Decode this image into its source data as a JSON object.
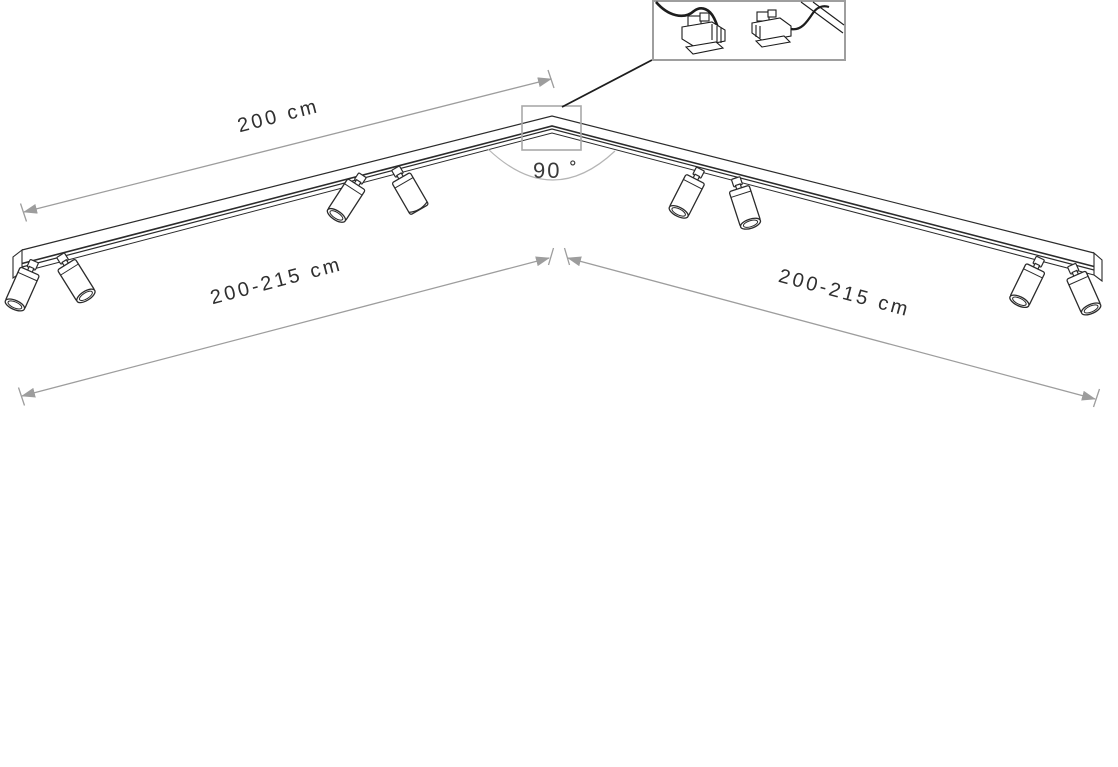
{
  "diagram": {
    "type": "product-dimension-diagram",
    "subject": "corner ceiling track lighting system with adjustable spotlights",
    "labels": {
      "track_length_top": "200 cm",
      "span_left": "200-215 cm",
      "span_right": "200-215 cm",
      "corner_angle": "90 ˚"
    },
    "spotlight_count": 8,
    "track_segments": 2,
    "inset": {
      "content": "quick-connect wiring connectors detail"
    },
    "colors": {
      "line_art": "#2b2b2b",
      "dimension_lines": "#9d9d9d",
      "label_text": "#2f2f2f",
      "highlight_box": "#a9a9a9",
      "angle_arc": "#b5b5b5",
      "inset_border": "#9e9e9e",
      "background": "#ffffff"
    }
  }
}
